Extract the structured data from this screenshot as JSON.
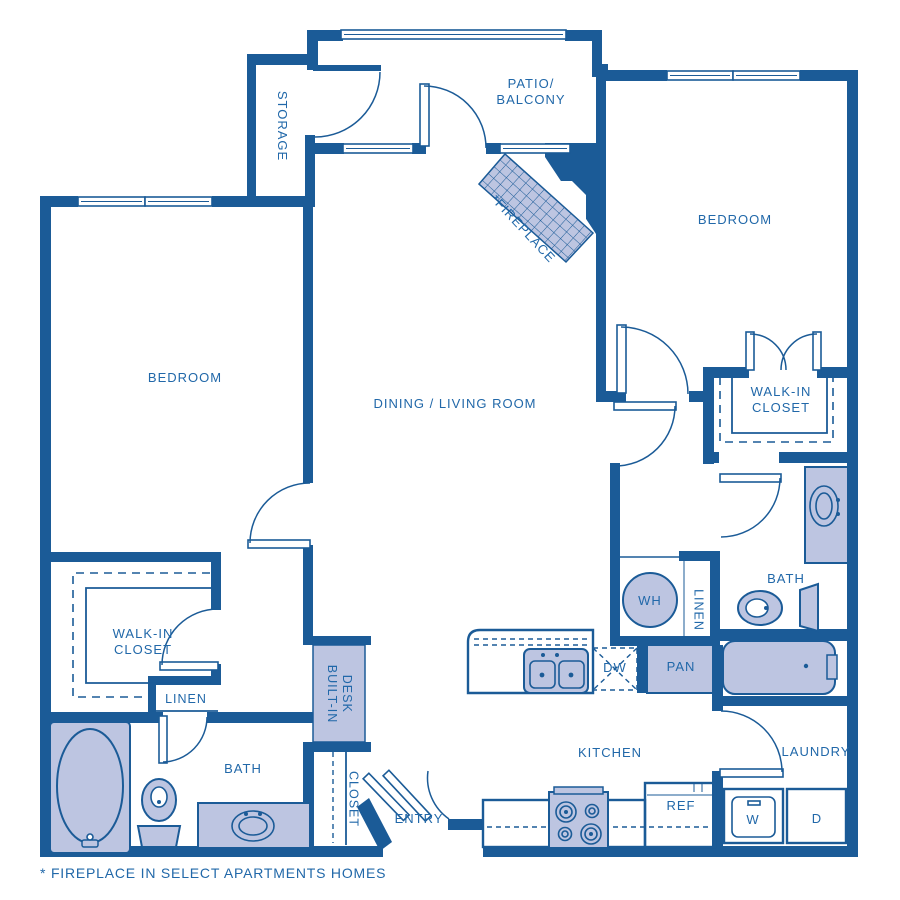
{
  "colors": {
    "wall": "#1b5b97",
    "text": "#2168a9",
    "fixture_fill": "#bdc5e1",
    "background": "#ffffff"
  },
  "labels": {
    "storage": "STORAGE",
    "patio_line1": "PATIO/",
    "patio_line2": "BALCONY",
    "fireplace": "*FIREPLACE",
    "bedroom_left": "BEDROOM",
    "bedroom_right": "BEDROOM",
    "dining_living": "DINING / LIVING ROOM",
    "walkin_right_line1": "WALK-IN",
    "walkin_right_line2": "CLOSET",
    "walkin_left_line1": "WALK-IN",
    "walkin_left_line2": "CLOSET",
    "linen_left": "LINEN",
    "linen_right": "LINEN",
    "water_heater": "WH",
    "dishwasher": "DW",
    "pantry": "PAN",
    "bath_left": "BATH",
    "bath_right": "BATH",
    "desk_line1": "BUILT-IN",
    "desk_line2": "DESK",
    "closet": "CLOSET",
    "entry": "ENTRY",
    "kitchen": "KITCHEN",
    "refrigerator": "REF",
    "washer": "W",
    "dryer": "D",
    "laundry": "LAUNDRY"
  },
  "footer": {
    "note": "* FIREPLACE IN SELECT APARTMENTS HOMES"
  }
}
